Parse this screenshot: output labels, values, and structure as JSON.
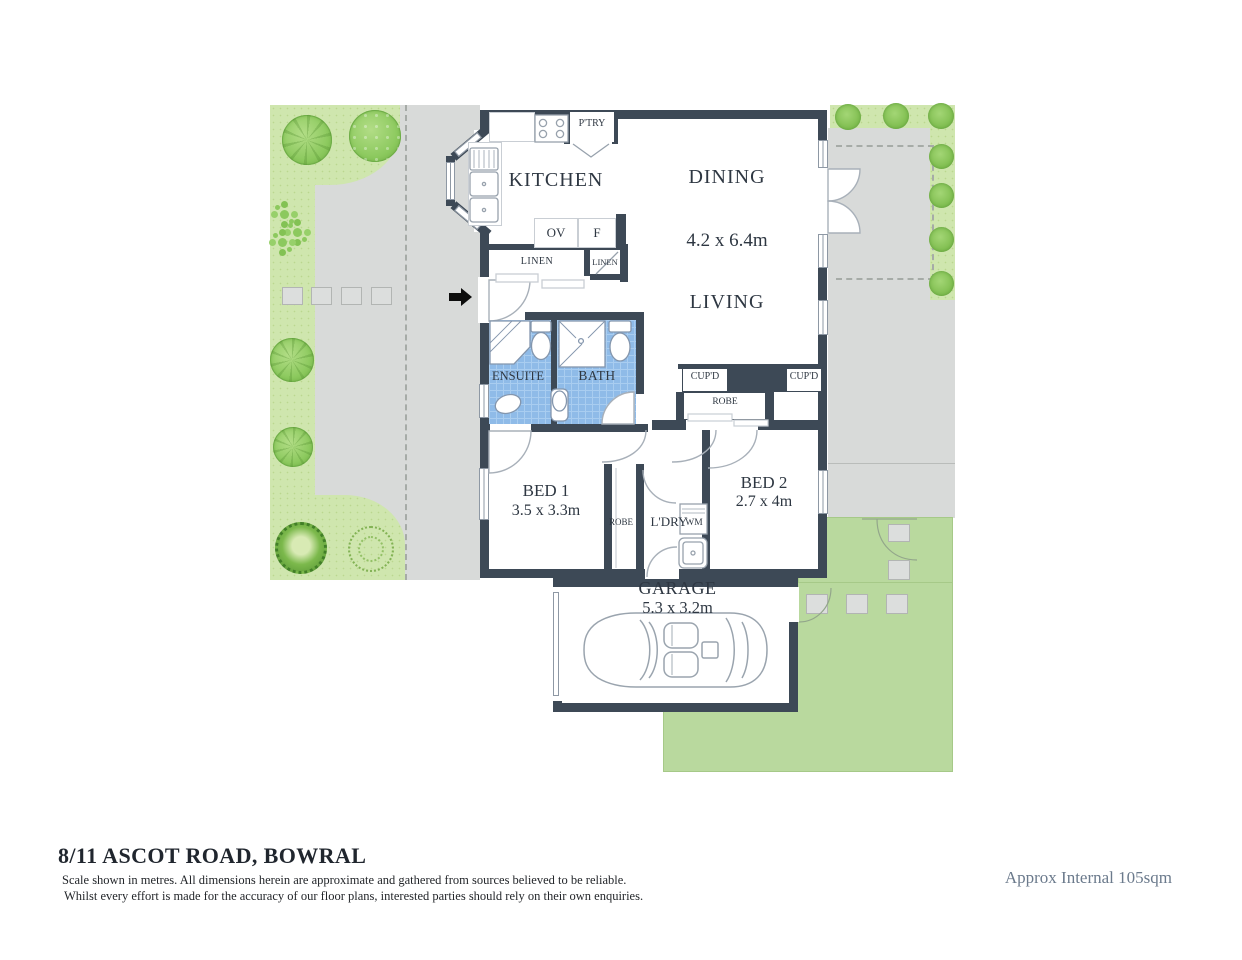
{
  "title": {
    "address": "8/11 ASCOT ROAD, BOWRAL",
    "disclaimer1": "Scale shown in metres. All dimensions herein are approximate and gathered from sources believed to be  reliable.",
    "disclaimer2": "Whilst every effort is made for the accuracy of our floor plans, interested parties should rely on their own enquiries.",
    "area_note": "Approx Internal 105sqm"
  },
  "rooms": {
    "kitchen": "KITCHEN",
    "dining": "DINING",
    "living": "LIVING",
    "living_dims": "4.2 x 6.4m",
    "ensuite": "ENSUITE",
    "bath": "BATH",
    "bed1": "BED 1",
    "bed1_dims": "3.5 x 3.3m",
    "bed2": "BED 2",
    "bed2_dims": "2.7 x 4m",
    "laundry": "L'DRY",
    "garage": "GARAGE",
    "garage_dims": "5.3 x 3.2m"
  },
  "closets": {
    "pantry": "P'TRY",
    "oven": "OV",
    "fridge": "F",
    "linen_large": "LINEN",
    "linen_small": "LINEN",
    "cupboard_left": "CUP'D",
    "cupboard_right": "CUP'D",
    "robe_bed2": "ROBE",
    "robe_bed1": "ROBE",
    "washing_machine": "WM"
  },
  "colors": {
    "wall": "#3d4956",
    "bathroom_tile": "#8fbbe8",
    "lawn_textured": "#cfe6ae",
    "lawn_flat": "#b9d99e",
    "paving": "#d8dad9",
    "tree_green": "#8cc95e"
  }
}
